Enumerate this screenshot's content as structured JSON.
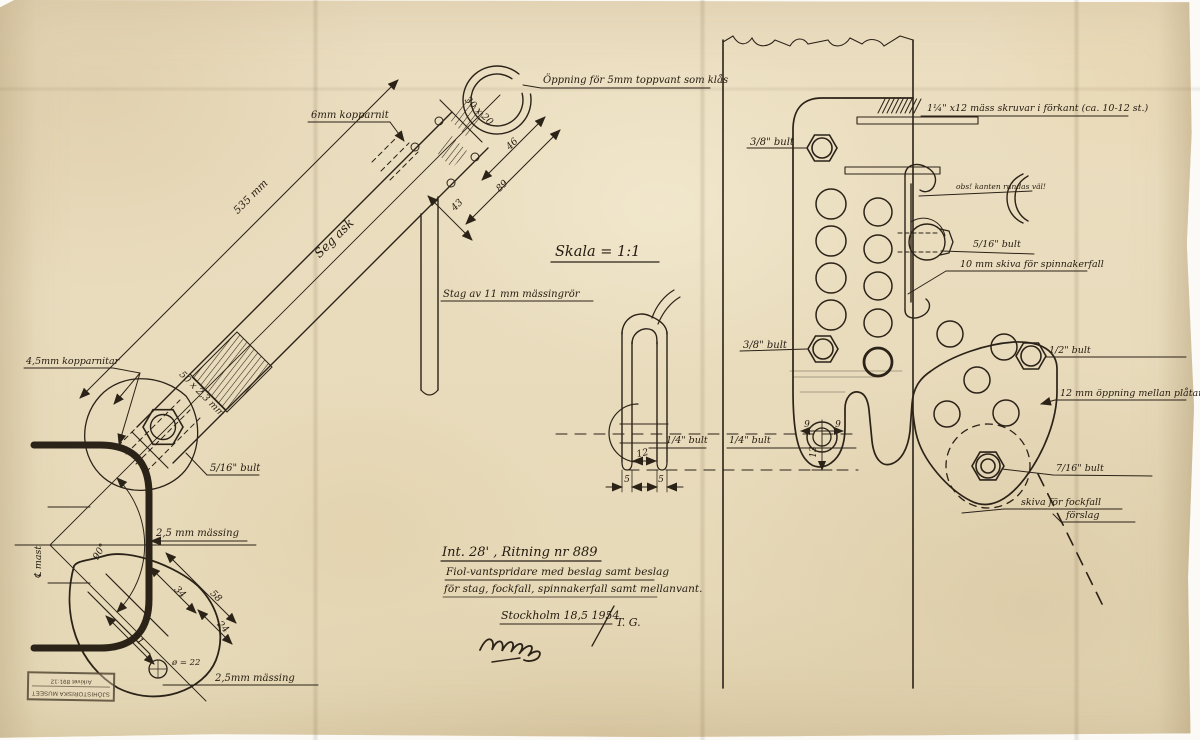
{
  "drawing": {
    "ink_color": "#2b2218",
    "paper_color": "#e9ddbe",
    "scale_note": "Skala = 1:1",
    "left": {
      "opening_label": "Öppning för 5mm toppvant som klås",
      "rivet6_label": "6mm kopparnit",
      "length_dim": "535 mm",
      "wood_label": "Seg ask",
      "tube_dim": "30 x 20",
      "dim46": "46",
      "dim89": "89",
      "dim43": "43",
      "stay_label": "Stag av 11 mm mässingrör",
      "rivets45_label": "4,5mm kopparnitar",
      "tube_size_label": "50 x 2,3 mm",
      "bolt516_label": "5/16\" bult",
      "brass25_upper": "2,5 mm mässing",
      "angle90": "90°",
      "mast_centerline": "℄ mast",
      "dim34": "34",
      "dim58": "58",
      "dim24": "24",
      "dim51": "51",
      "hole22": "ø = 22",
      "brass25_lower": "2,5mm mässing"
    },
    "middle": {
      "shackle_bolt_left": "1/4\" bult",
      "shackle_bolt_right": "1/4\" bult",
      "dim12": "12",
      "dim5a": "5",
      "dim5b": "5"
    },
    "right": {
      "screws_label": "1¼\" x12 mäss skruvar i förkant (ca. 10-12 st.)",
      "bolt38_top": "3/8\" bult",
      "edge_note": "obs! kanten rundas väl!",
      "bolt516": "5/16\" bult",
      "sheave10_label": "10 mm skiva för spinnakerfall",
      "bolt38_mid": "3/8\" bult",
      "bolt12": "1/2\" bult",
      "gap12_label": "12 mm öppning mellan plåtarna",
      "bolt716": "7/16\" bult",
      "sheave_fock": "skiva för fockfall",
      "proposal": "förslag",
      "dim9a": "9",
      "dim9b": "9",
      "dim13": "13"
    },
    "title_block": {
      "line1": "Int. 28' , Ritning nr 889",
      "line2": "Fiol-vantspridare med beslag samt beslag",
      "line3": "för stag, fockfall, spinnakerfall samt mellanvant.",
      "place_date": "Stockholm 18,5 1954",
      "initials": "T. G."
    },
    "stamp": {
      "line1": "SJÖHISTORISKA MUSEET",
      "line2": "Arkivet 891:12"
    }
  }
}
